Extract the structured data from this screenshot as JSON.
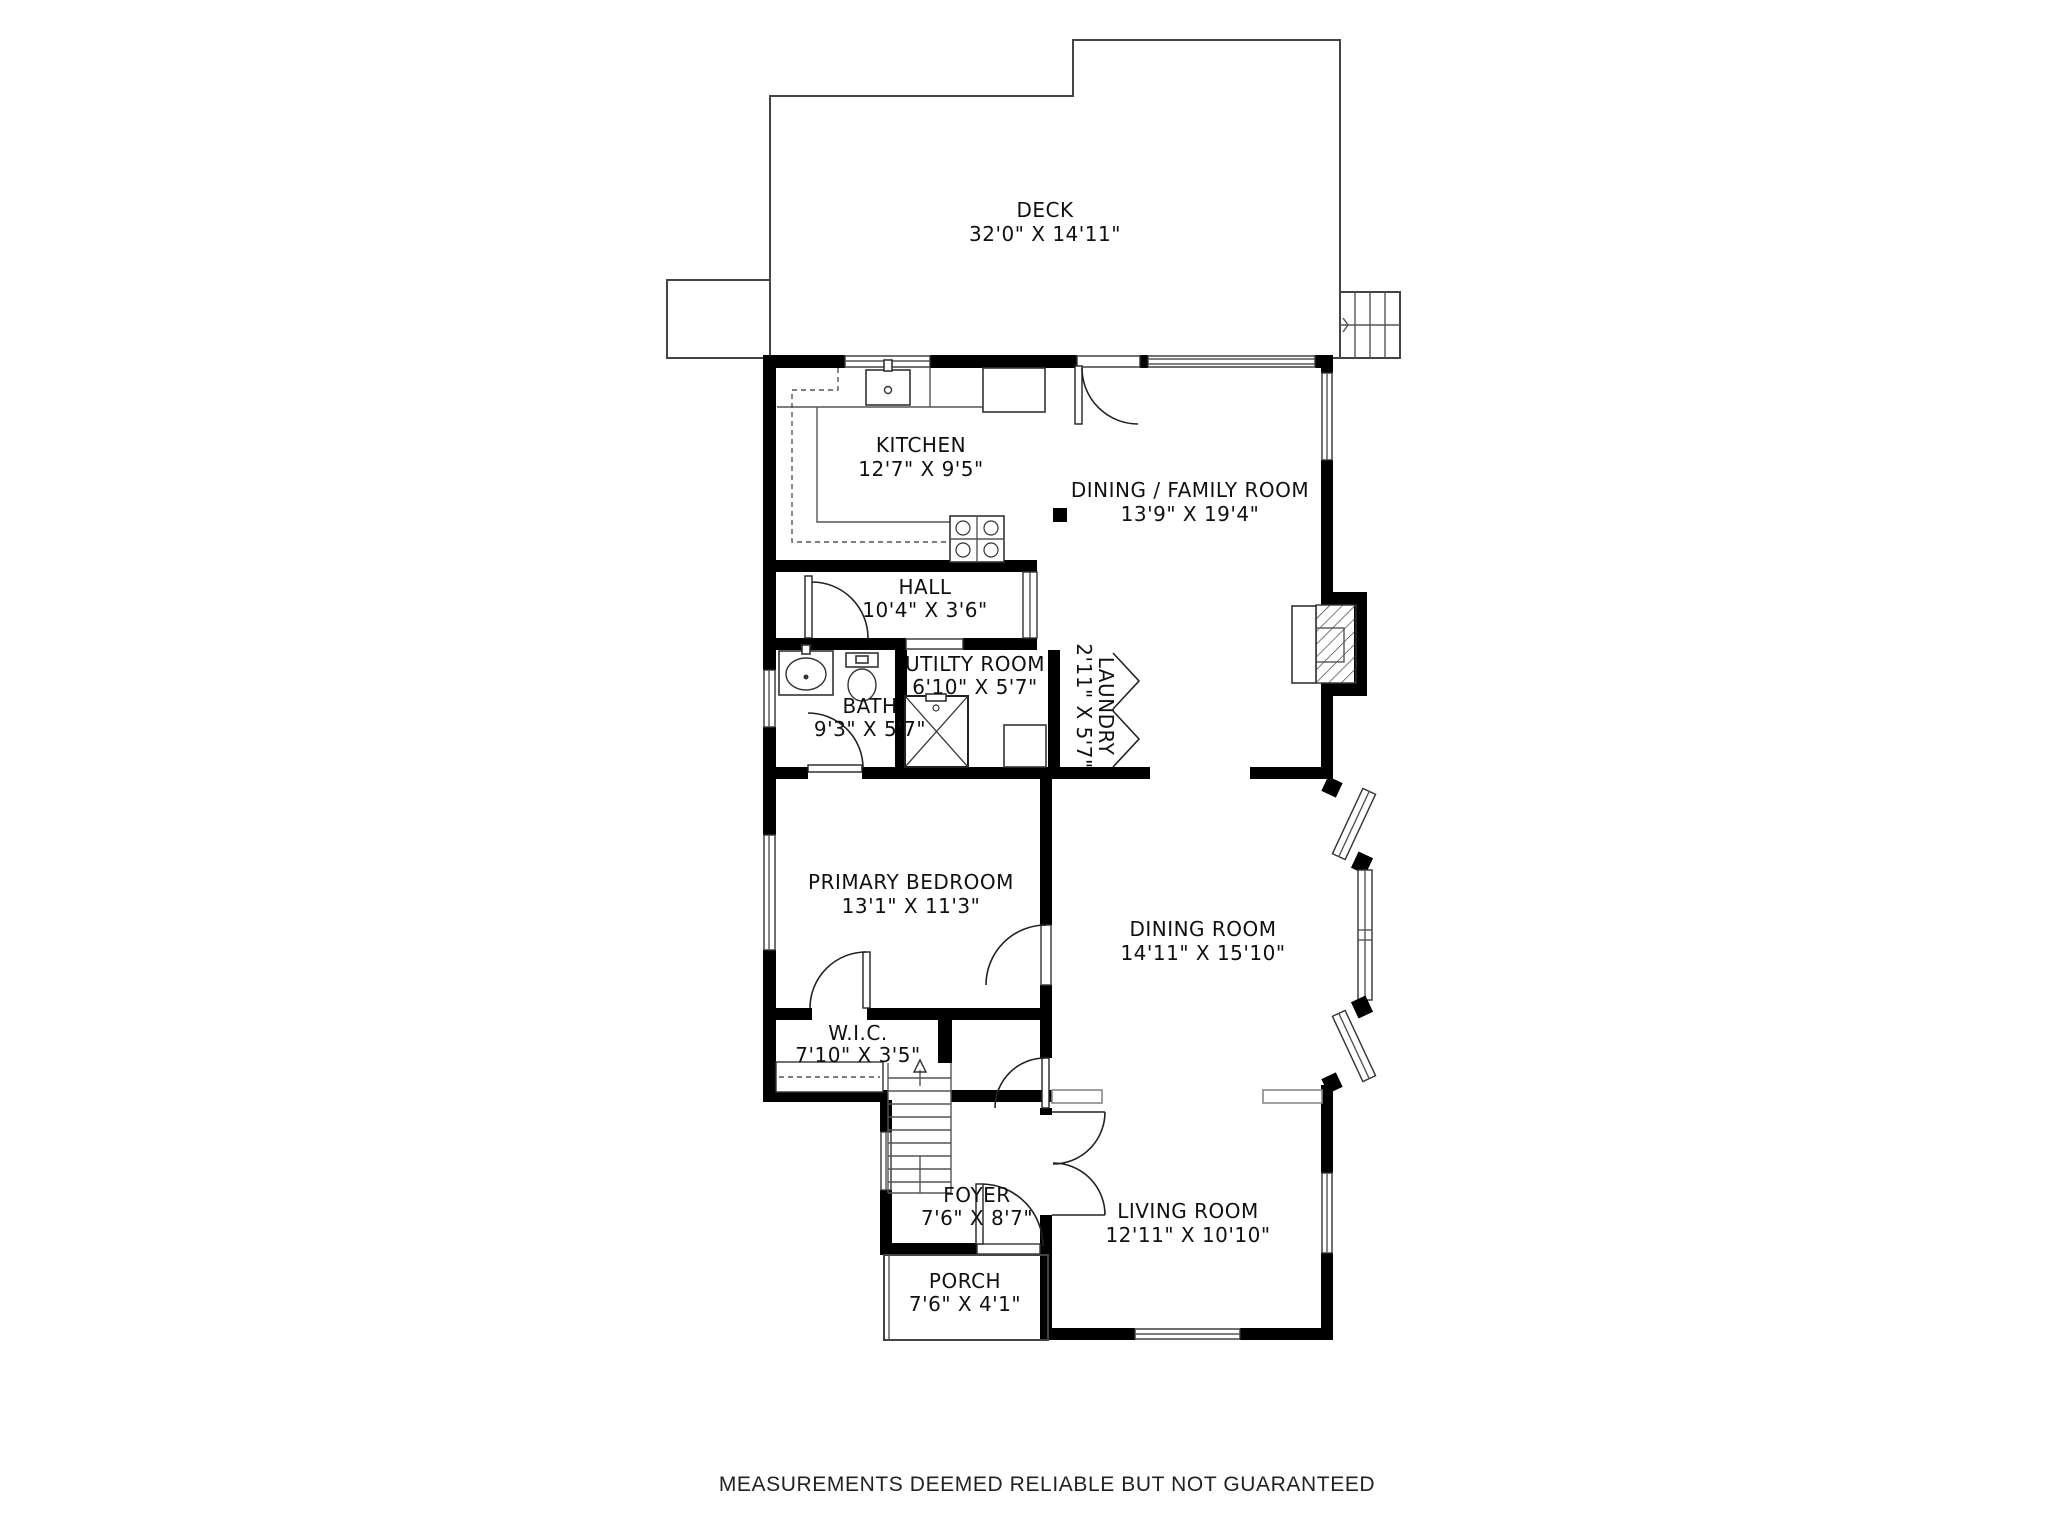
{
  "page": {
    "background": "#ffffff",
    "footer": "MEASUREMENTS DEEMED RELIABLE BUT NOT GUARANTEED"
  },
  "colors": {
    "wall": "#000000",
    "outline": "#444444",
    "label": "#111111"
  },
  "rooms": [
    {
      "id": "deck",
      "name": "DECK",
      "dims": "32'0\" X 14'11\""
    },
    {
      "id": "kitchen",
      "name": "KITCHEN",
      "dims": "12'7\" X 9'5\""
    },
    {
      "id": "dining-family",
      "name": "DINING / FAMILY ROOM",
      "dims": "13'9\" X 19'4\""
    },
    {
      "id": "hall",
      "name": "HALL",
      "dims": "10'4\" X 3'6\""
    },
    {
      "id": "utility",
      "name": "UTILTY ROOM",
      "dims": "6'10\" X 5'7\""
    },
    {
      "id": "laundry",
      "name": "LAUNDRY",
      "dims": "2'11\" X 5'7\""
    },
    {
      "id": "bath",
      "name": "BATH",
      "dims": "9'3\" X 5'7\""
    },
    {
      "id": "primary-bedroom",
      "name": "PRIMARY BEDROOM",
      "dims": "13'1\" X 11'3\""
    },
    {
      "id": "dining-room",
      "name": "DINING ROOM",
      "dims": "14'11\" X 15'10\""
    },
    {
      "id": "wic",
      "name": "W.I.C.",
      "dims": "7'10\" X 3'5\""
    },
    {
      "id": "foyer",
      "name": "FOYER",
      "dims": "7'6\" X 8'7\""
    },
    {
      "id": "living-room",
      "name": "LIVING ROOM",
      "dims": "12'11\" X 10'10\""
    },
    {
      "id": "porch",
      "name": "PORCH",
      "dims": "7'6\" X 4'1\""
    }
  ]
}
